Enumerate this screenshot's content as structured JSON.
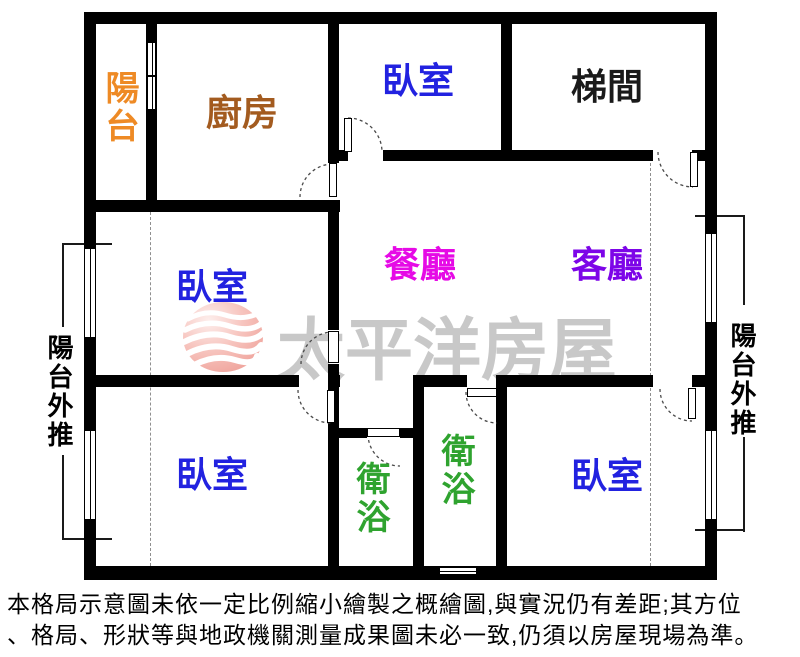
{
  "floorplan": {
    "rooms": [
      {
        "key": "balcony_top_left",
        "label": "陽台",
        "color": "#EE8A25"
      },
      {
        "key": "kitchen",
        "label": "廚房",
        "color": "#A35B1F"
      },
      {
        "key": "bedroom_top",
        "label": "臥室",
        "color": "#2222E0"
      },
      {
        "key": "stairwell",
        "label": "梯間",
        "color": "#1A1A1A"
      },
      {
        "key": "bedroom_mid_left",
        "label": "臥室",
        "color": "#2222E0"
      },
      {
        "key": "dining_room",
        "label": "餐廳",
        "color": "#E60AE6"
      },
      {
        "key": "living_room",
        "label": "客廳",
        "color": "#7D05E8"
      },
      {
        "key": "bedroom_bottom_left",
        "label": "臥室",
        "color": "#2222E0"
      },
      {
        "key": "bathroom_left",
        "label": "衛浴",
        "color": "#2FA32F"
      },
      {
        "key": "bathroom_middle",
        "label": "衛浴",
        "color": "#2FA32F"
      },
      {
        "key": "bedroom_bottom_right",
        "label": "臥室",
        "color": "#2222E0"
      }
    ],
    "side_notes": {
      "left": {
        "text": "陽台外推",
        "color": "#000000"
      },
      "right": {
        "text": "陽台外推",
        "color": "#000000"
      }
    }
  },
  "watermark": {
    "text": "太平洋房屋",
    "color": "#C8C8C8",
    "logo": "pacific-rehouse-wave-sphere-logo",
    "logo_colors": {
      "sphere": "#F6B9B2",
      "waves": "#FFFFFF"
    }
  },
  "disclaimer": {
    "lines": [
      "本格局示意圖未依一定比例縮小繪製之概繪圖,與實況仍有差距;其方位",
      "、格局、形狀等與地政機關測量成果圖未必一致,仍須以房屋現場為準。"
    ],
    "color": "#000000"
  }
}
